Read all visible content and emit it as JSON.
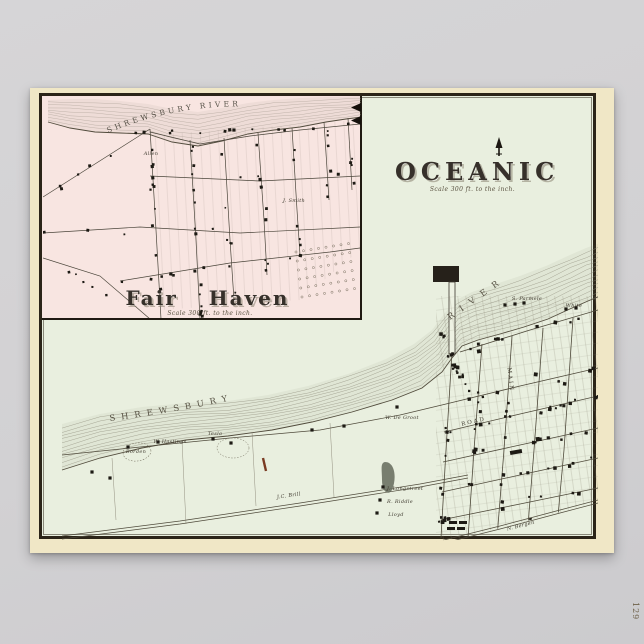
{
  "page": {
    "number_label": "129"
  },
  "colors": {
    "backdrop": "#d3d2d4",
    "paper": "#f0e7c6",
    "map_ground": "#e9efdf",
    "inset_ground": "#f8e5e1",
    "frame": "#2b2418",
    "ink": "#3f3a2f",
    "hachure": "#8e8b7a",
    "red_mark": "#7a3b22"
  },
  "main_map": {
    "title": "OCEANIC",
    "scale_note": "Scale 300 ft. to the inch.",
    "river_name_word1": "SHREWSBURY",
    "river_name_word2": "RIVER",
    "street_labels": [
      {
        "text": "ROAD",
        "x": 474,
        "y": 423,
        "rotate": -13,
        "spacing": 2
      },
      {
        "text": "MAIN",
        "x": 509,
        "y": 380,
        "rotate": 83,
        "spacing": 2
      }
    ],
    "property_labels": [
      {
        "text": "W. Hastings",
        "x": 170,
        "y": 443
      },
      {
        "text": "Tesla",
        "x": 215,
        "y": 435
      },
      {
        "text": "Borden",
        "x": 136,
        "y": 453
      },
      {
        "text": "W. De Groot",
        "x": 402,
        "y": 419
      },
      {
        "text": "S. Parmele",
        "x": 527,
        "y": 300
      },
      {
        "text": "White",
        "x": 574,
        "y": 307
      },
      {
        "text": "J. Longstreet",
        "x": 405,
        "y": 490
      },
      {
        "text": "R. Riddle",
        "x": 400,
        "y": 503
      },
      {
        "text": "Lloyd",
        "x": 396,
        "y": 516
      },
      {
        "text": "J.C. Brill",
        "x": 289,
        "y": 497,
        "rotate": -8
      },
      {
        "text": "N. Bergen",
        "x": 521,
        "y": 527,
        "rotate": -14
      }
    ]
  },
  "inset_map": {
    "title": "Fair Haven",
    "scale_note": "Scale 300 ft. to the inch.",
    "river_name": "SHREWSBURY RIVER",
    "property_labels": [
      {
        "text": "Allen",
        "x": 151,
        "y": 155
      },
      {
        "text": "J. Smith",
        "x": 294,
        "y": 202
      }
    ]
  }
}
